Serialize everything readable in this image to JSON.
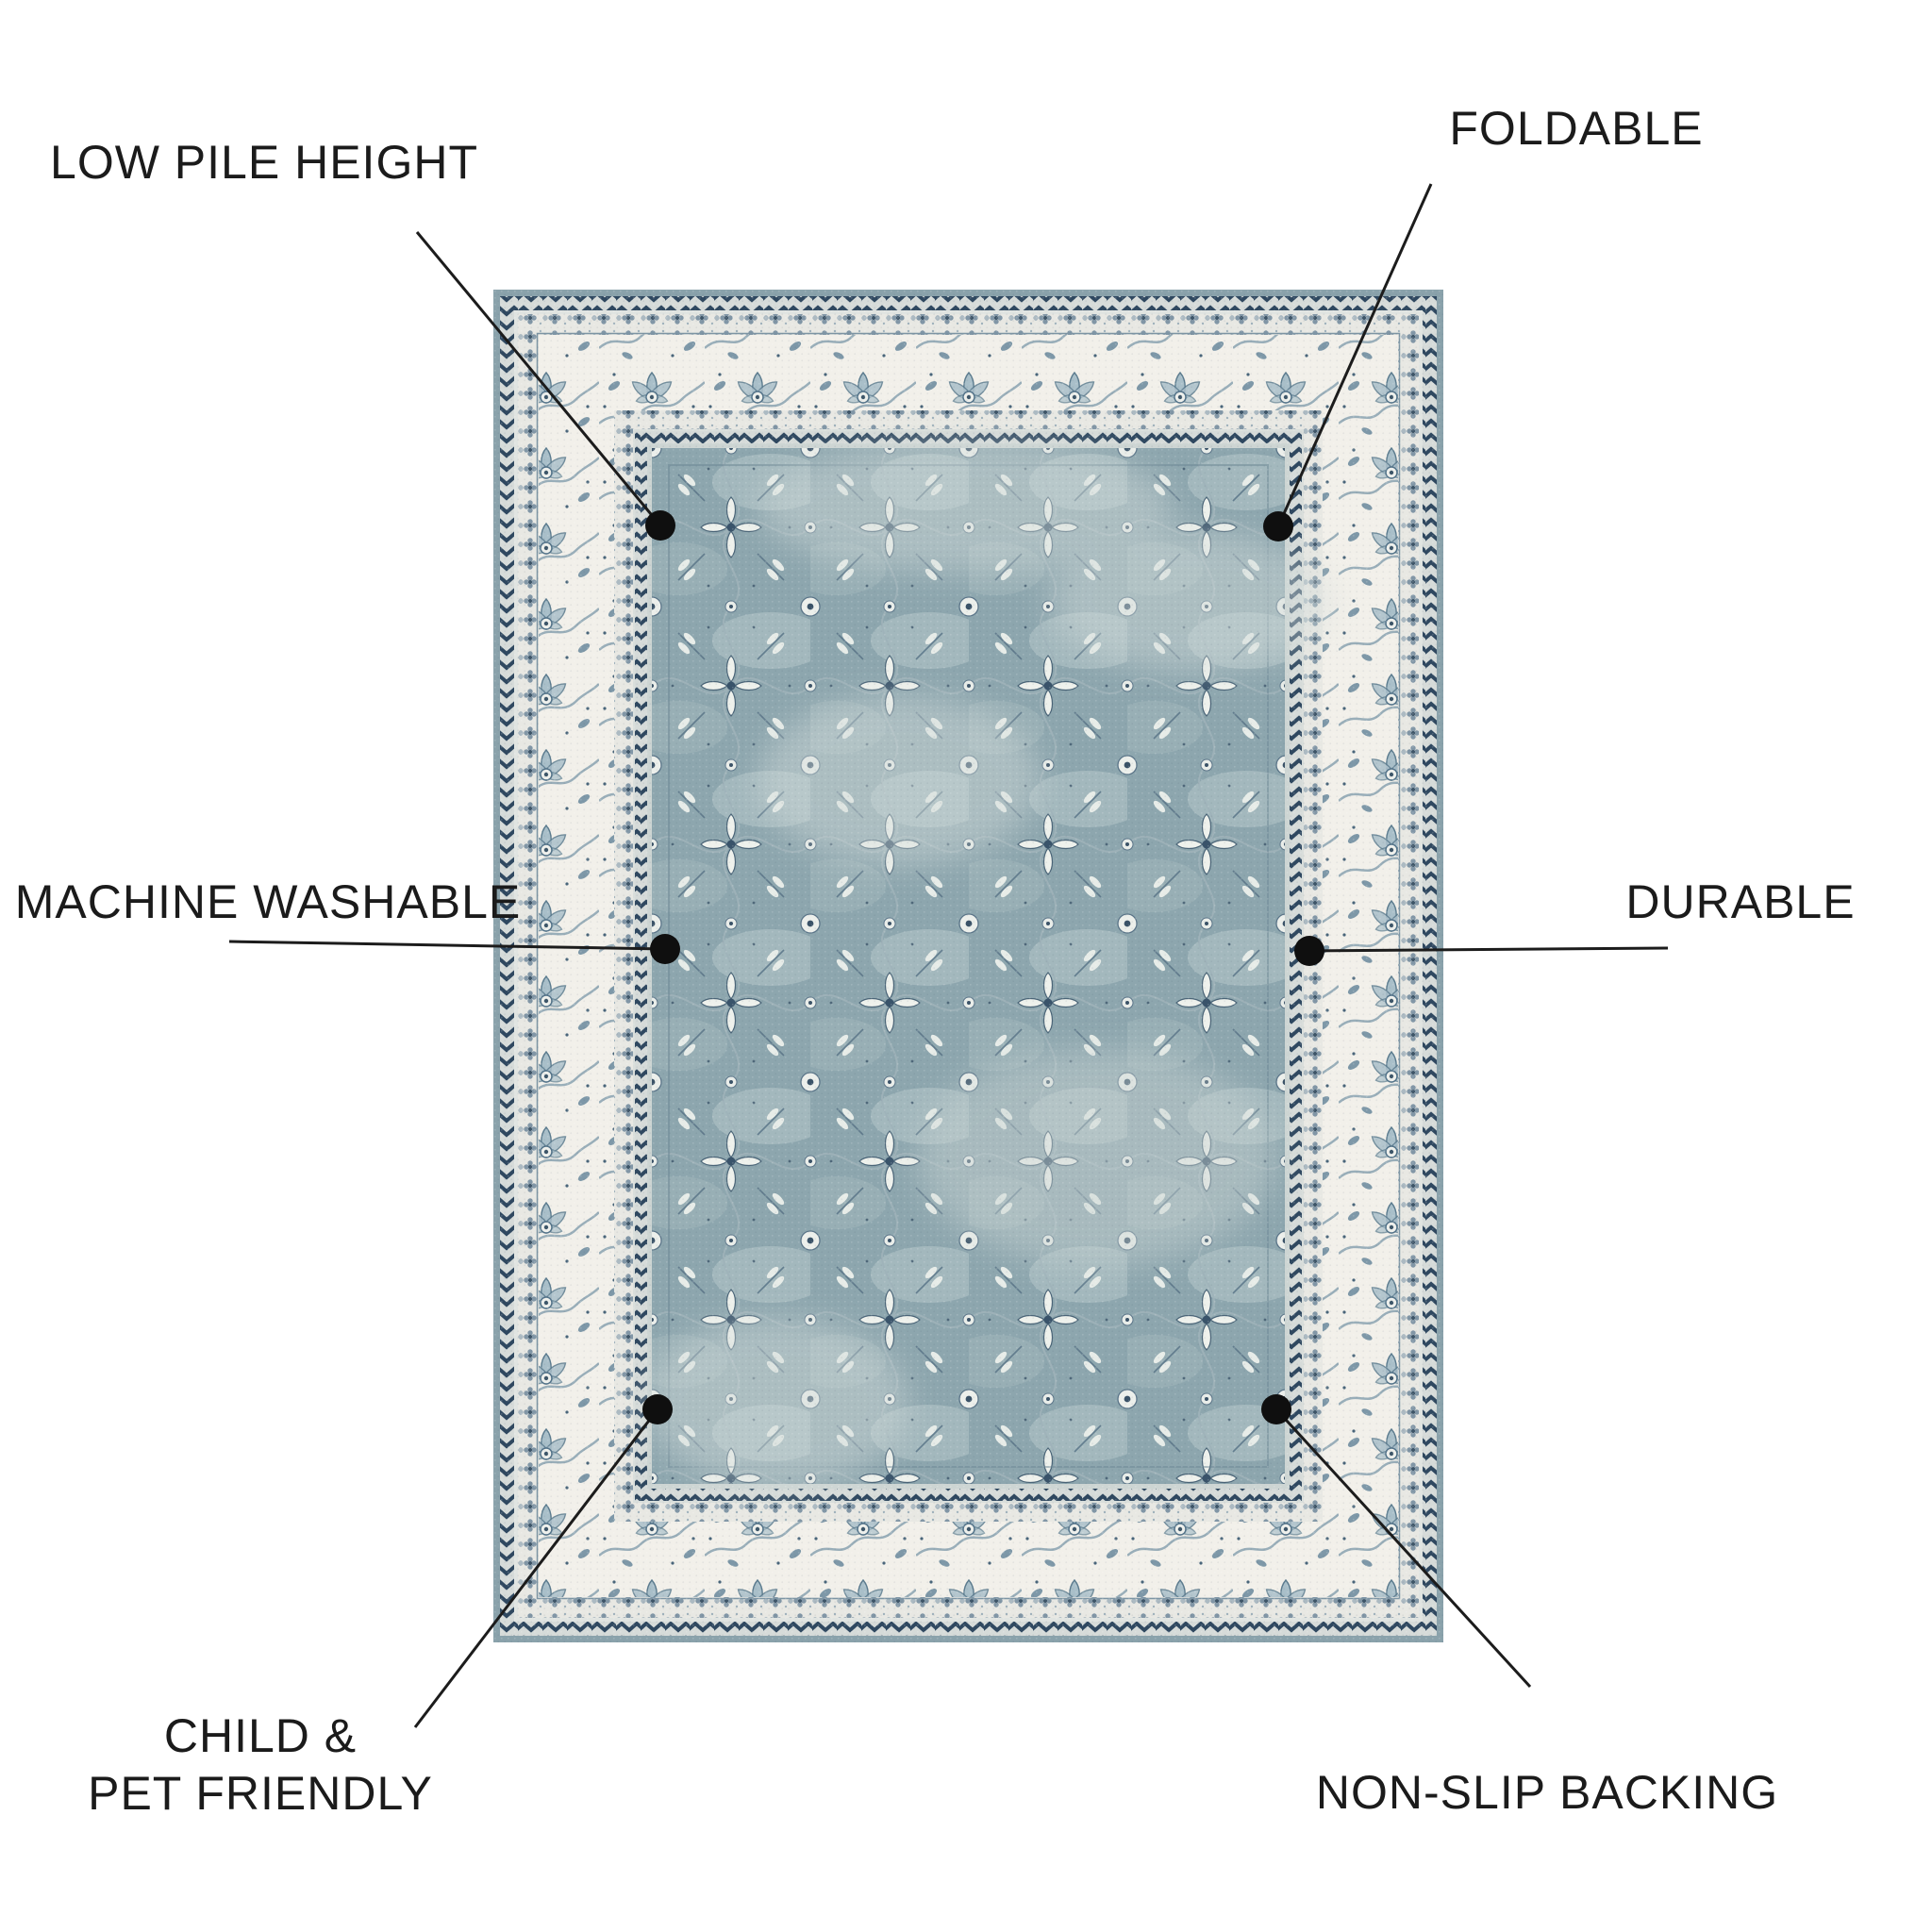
{
  "page": {
    "background": "#ffffff",
    "kind": "rug product feature infographic"
  },
  "colors": {
    "page-bg": "#ffffff",
    "label-color": "#1b1b1b",
    "line-color": "#1c1c1c",
    "dot-color": "#0f0f0f",
    "rug-field-blue": "#8da6ae",
    "rug-border-ivory": "#f2f0ea",
    "rug-accent-navy": "#2f4860",
    "rug-motif-blue": "#7e98a8"
  },
  "features": [
    {
      "id": "low-pile-height",
      "lines": [
        "LOW PILE HEIGHT"
      ]
    },
    {
      "id": "foldable",
      "lines": [
        "FOLDABLE"
      ]
    },
    {
      "id": "machine-washable",
      "lines": [
        "MACHINE WASHABLE"
      ]
    },
    {
      "id": "durable",
      "lines": [
        "DURABLE"
      ]
    },
    {
      "id": "child-pet-friendly",
      "lines": [
        "CHILD &",
        "PET FRIENDLY"
      ]
    },
    {
      "id": "non-slip-backing",
      "lines": [
        "NON-SLIP BACKING"
      ]
    }
  ]
}
